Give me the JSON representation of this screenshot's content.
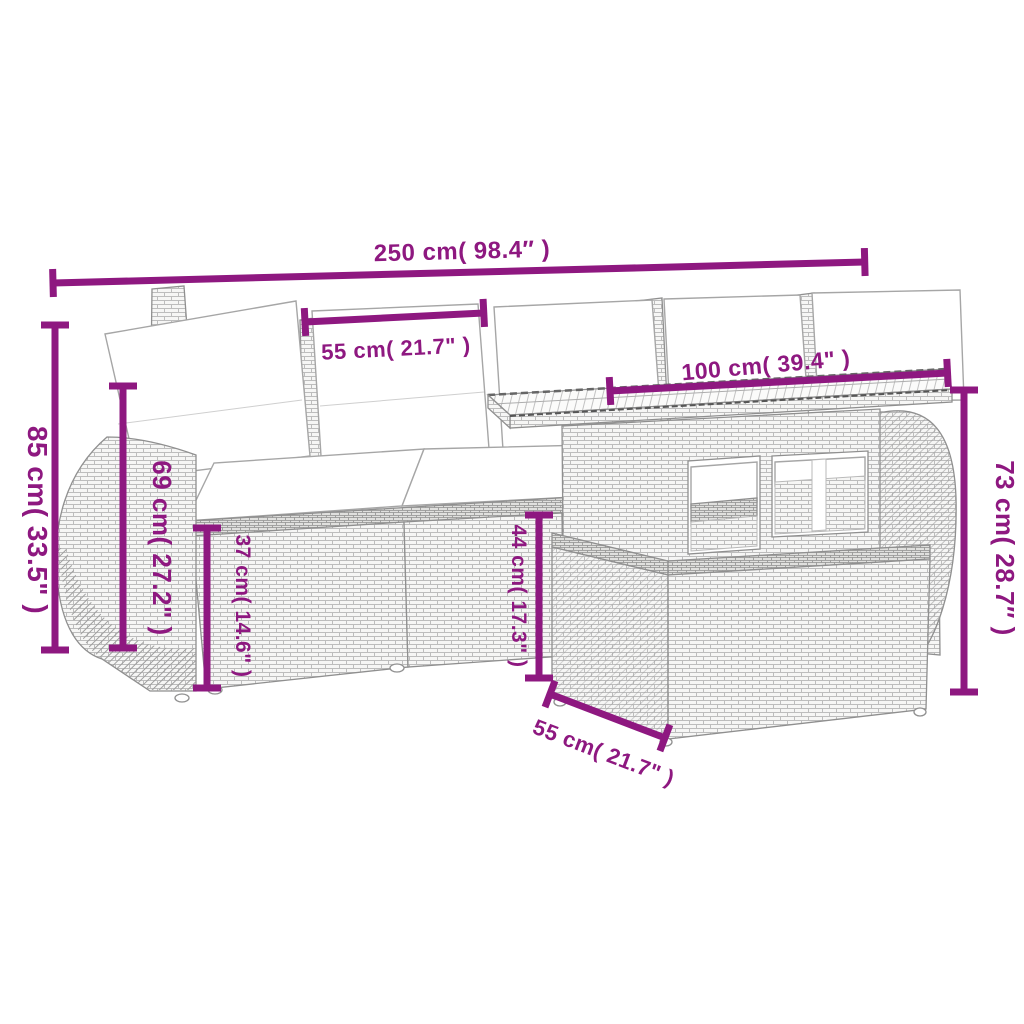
{
  "figure": {
    "kind": "product dimension diagram",
    "subject": "rattan garden lounge set: sofa with white cushions, ottoman and slat-top table",
    "background_color": "#ffffff",
    "dimension_color": "#8E1880",
    "line_art_color": "#8f8f8f",
    "cushion_color": "#ffffff"
  },
  "labels": {
    "overall_width": "250 cm( 98.4″ )",
    "seat_module_width": "55 cm( 21.7\" )",
    "table_width": "100 cm( 39.4\" )",
    "overall_height": "85 cm( 33.5\" )",
    "backrest_height": "69 cm( 27.2\" )",
    "seat_height": "37 cm( 14.6\" )",
    "ottoman_height": "44 cm( 17.3\" )",
    "table_height": "73 cm( 28.7″ )",
    "ottoman_depth": "55 cm( 21.7\" )"
  }
}
